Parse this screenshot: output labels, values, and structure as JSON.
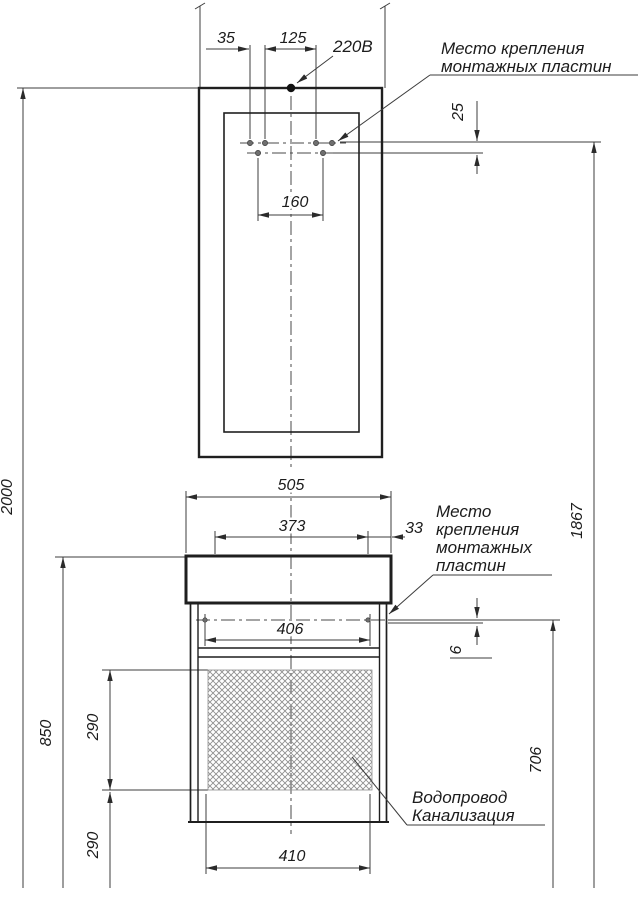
{
  "drawing": {
    "labels": {
      "power": "220В",
      "mounting_plates_top": {
        "line1": "Место крепления",
        "line2": "монтажных пластин"
      },
      "mounting_plates_cabinet": {
        "line1": "Место",
        "line2": "крепления",
        "line3": "монтажных",
        "line4": "пластин"
      },
      "plumbing": {
        "line1": "Водопровод",
        "line2": "Канализация"
      }
    },
    "dimensions_mm": {
      "socket_offset": "35",
      "socket_to_plate": "125",
      "plate_rows_gap": "25",
      "mirror_plates_span": "160",
      "countertop_width": "505",
      "cabinet_plates_span": "373",
      "plate_to_edge": "33",
      "cabinet_inner_width": "406",
      "plate_line_offset": "6",
      "hatch_zone_height": "290",
      "below_hatch_height": "290",
      "countertop_height": "850",
      "overall_height": "2000",
      "cabinet_plate_height": "706",
      "mirror_plate_height": "1867",
      "drain_zone_width": "410"
    },
    "colors": {
      "line": "#1f1f1f",
      "dim_line": "#3c3c3c",
      "hatch": "#8f8f8f",
      "background": "#ffffff"
    }
  }
}
